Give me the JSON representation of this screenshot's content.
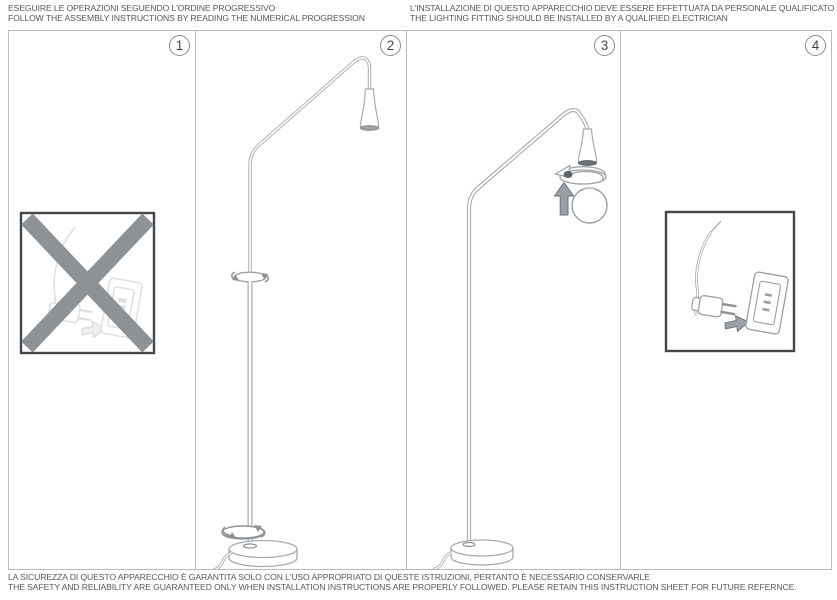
{
  "header": {
    "left": {
      "line1": "ESEGUIRE LE OPERAZIONI SEGUENDO L'ORDINE PROGRESSIVO",
      "line2": "FOLLOW THE ASSEMBLY INSTRUCTIONS BY READING THE NUMERICAL PROGRESSION"
    },
    "right": {
      "line1": "L'INSTALLAZIONE DI QUESTO APPARECCHIO DEVE ESSERE EFFETTUATA DA PERSONALE QUALIFICATO",
      "line2": "THE LIGHTING FITTING SHOULD BE INSTALLED BY A QUALIFIED ELECTRICIAN"
    }
  },
  "footer": {
    "line1": "LA SICUREZZA DI QUESTO APPARECCHIO È GARANTITA SOLO CON L'USO APPROPRIATO DI QUESTE ISTRUZIONI, PERTANTO È NECESSARIO CONSERVARLE",
    "line2": "THE SAFETY AND RELIABILITY ARE GUARANTEED ONLY WHEN INSTALLATION INSTRUCTIONS ARE PROPERLY FOLLOWED. PLEASE RETAIN THIS INSTRUCTION SHEET FOR FUTURE REFERNCE."
  },
  "panels": [
    {
      "number": "1",
      "icon": "crossed-out-plug-icon"
    },
    {
      "number": "2",
      "icon": "floor-lamp-pole-assembly-illustration"
    },
    {
      "number": "3",
      "icon": "bulb-insertion-illustration"
    },
    {
      "number": "4",
      "icon": "plug-into-socket-illustration"
    }
  ],
  "colors": {
    "line_art": "#a6abaf",
    "dark_outline": "#43474b",
    "prohibition_x": "#8d9297",
    "arrow_fill": "#9aa0a5",
    "text": "#55595c"
  }
}
